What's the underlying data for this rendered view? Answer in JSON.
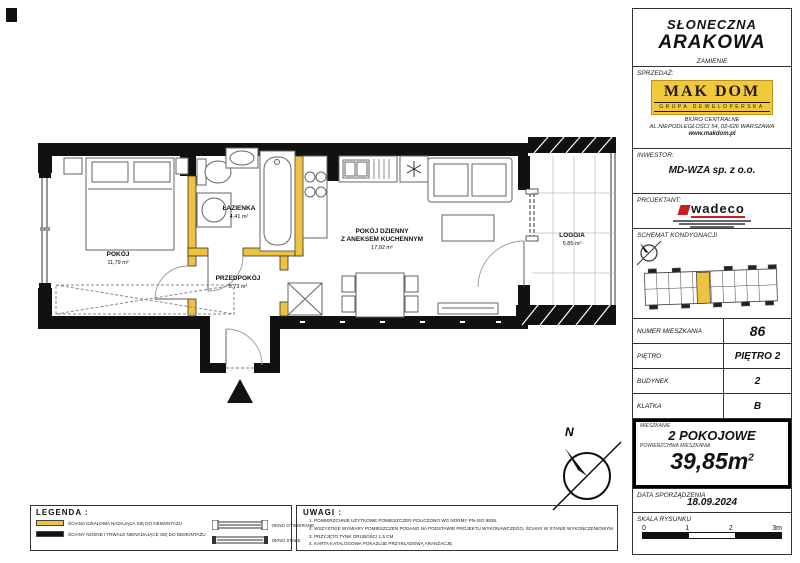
{
  "titlebox": {
    "line1": "SŁONECZNA",
    "line2": "ARAKOWA",
    "location": "ZAMIENIE"
  },
  "sales": {
    "label": "SPRZEDAŻ:",
    "brand": "MAK DOM",
    "brand_sub": "GRUPA DEWELOPERSKA",
    "office_line1": "BIURO CENTRALNE",
    "office_line2": "AL.NIEPODLEGŁOŚCI 54, 02-626 WARSZAWA",
    "website": "www.makdom.pl"
  },
  "investor": {
    "label": "INWESTOR:",
    "value": "MD-WZA sp. z o.o."
  },
  "designer": {
    "label": "PROJEKTANT:",
    "brand": "wadeco"
  },
  "scheme": {
    "label": "SCHEMAT KONDYGNACJI",
    "highlight_color": "#eec23c"
  },
  "details": {
    "rows": [
      {
        "label": "NUMER MIESZKANIA",
        "value": "86"
      },
      {
        "label": "PIĘTRO",
        "value": "PIĘTRO 2"
      },
      {
        "label": "BUDYNEK",
        "value": "2"
      },
      {
        "label": "KLATKA",
        "value": "B"
      }
    ]
  },
  "summary": {
    "apartment_label": "MIESZKANIE",
    "apartment_type": "2 POKOJOWE",
    "area_label": "POWIERZCHNIA MIESZKANIA",
    "area_value": "39,85m",
    "area_sup": "2"
  },
  "date": {
    "label": "DATA SPORZĄDZENIA",
    "value": "18.09.2024"
  },
  "scale": {
    "label": "SKALA RYSUNKU",
    "ticks": [
      "0",
      "1",
      "2",
      "3m"
    ]
  },
  "legend": {
    "title": "LEGENDA :",
    "items": [
      {
        "label": "ŚCIANA DZIAŁOWA NADAJĄCA SIĘ DO DEMONTAŻU"
      },
      {
        "label": "ŚCIANY NOŚNE I TRWALE NIENADAJĄCE SIĘ DO DEMONTAŻU"
      },
      {
        "label": "OKNO OTWIERANE"
      },
      {
        "label": "OKNO STAŁE"
      }
    ]
  },
  "notes": {
    "title": "UWAGI :",
    "items": [
      "1. POWIERZCHNIE UŻYTKOWE POMIESZCZEŃ POLICZONO WG NORMY PN-ISO 9836.",
      "2. WSZYSTKIE WYMIARY POMIESZCZEŃ PODANO NA PODSTAWIE PROJEKTU WYKONAWCZEGO, ŚCIANY W STANIE WYKOŃCZENIOWYM",
      "3. PRZYJĘTO TYNK GRUBOŚCI 1,5 CM",
      "4. KARTA KATALOGOWA POKAZUJE PRZYKŁADOWĄ ARANŻACJĘ"
    ]
  },
  "plan": {
    "compass_label": "N",
    "wall_colors": {
      "partition": "#eec23c",
      "structural": "#111111"
    },
    "rooms": [
      {
        "name": "POKÓJ",
        "area": "11,79 m²"
      },
      {
        "name": "ŁAZIENKA",
        "area": "4,41 m²"
      },
      {
        "name": "PRZEDPOKÓJ",
        "area": "5,73 m²"
      },
      {
        "name": "POKÓJ DZIENNY",
        "name2": "Z ANEKSEM KUCHENNYM",
        "area": "17,92 m²"
      },
      {
        "name": "LOGGIA",
        "area": "5,85 m²"
      }
    ]
  }
}
